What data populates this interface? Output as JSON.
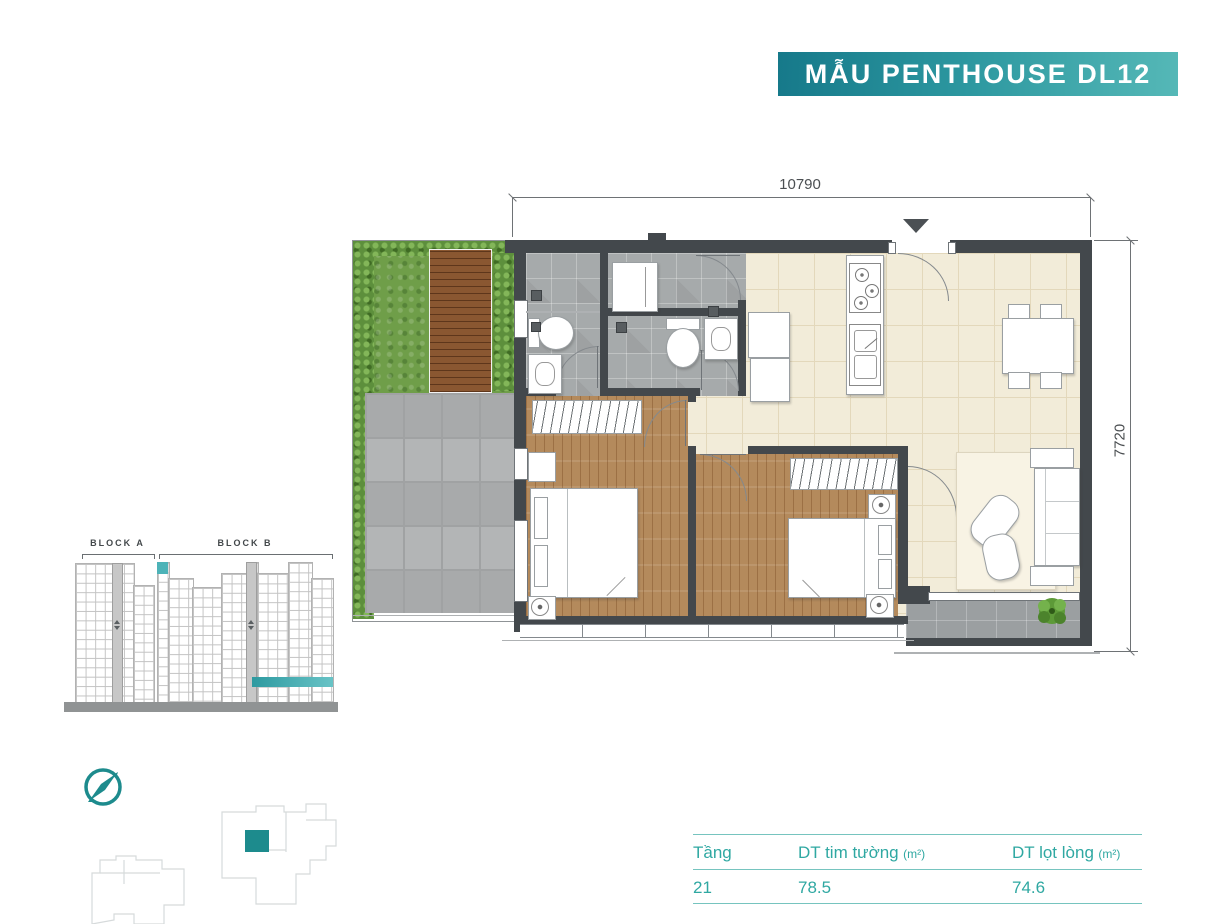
{
  "banner": {
    "title": "MẪU PENTHOUSE DL12"
  },
  "plan": {
    "dim_width": "10790",
    "dim_height": "7720"
  },
  "elevation": {
    "block_a": "BLOCK A",
    "block_b": "BLOCK B"
  },
  "table": {
    "col_floor": "Tầng",
    "col_wall_area": "DT tim tường",
    "col_wall_area_unit": "(m²)",
    "col_net_area": "DT lọt lòng",
    "col_net_area_unit": "(m²)",
    "floor_value": "21",
    "wall_area_value": "78.5",
    "net_area_value": "74.6"
  },
  "icons": {
    "compass": "compass-rose",
    "entry_marker": "entry-arrow-down",
    "elevator": "elevator-up-down-arrows",
    "plant": "potted-plant"
  },
  "colors": {
    "accent": "#2fa8a2",
    "banner_gradient_start": "#16798a",
    "banner_gradient_end": "#55b8b7",
    "highlight_teal": "#1d8b8d",
    "wall_dark": "#43484c"
  }
}
